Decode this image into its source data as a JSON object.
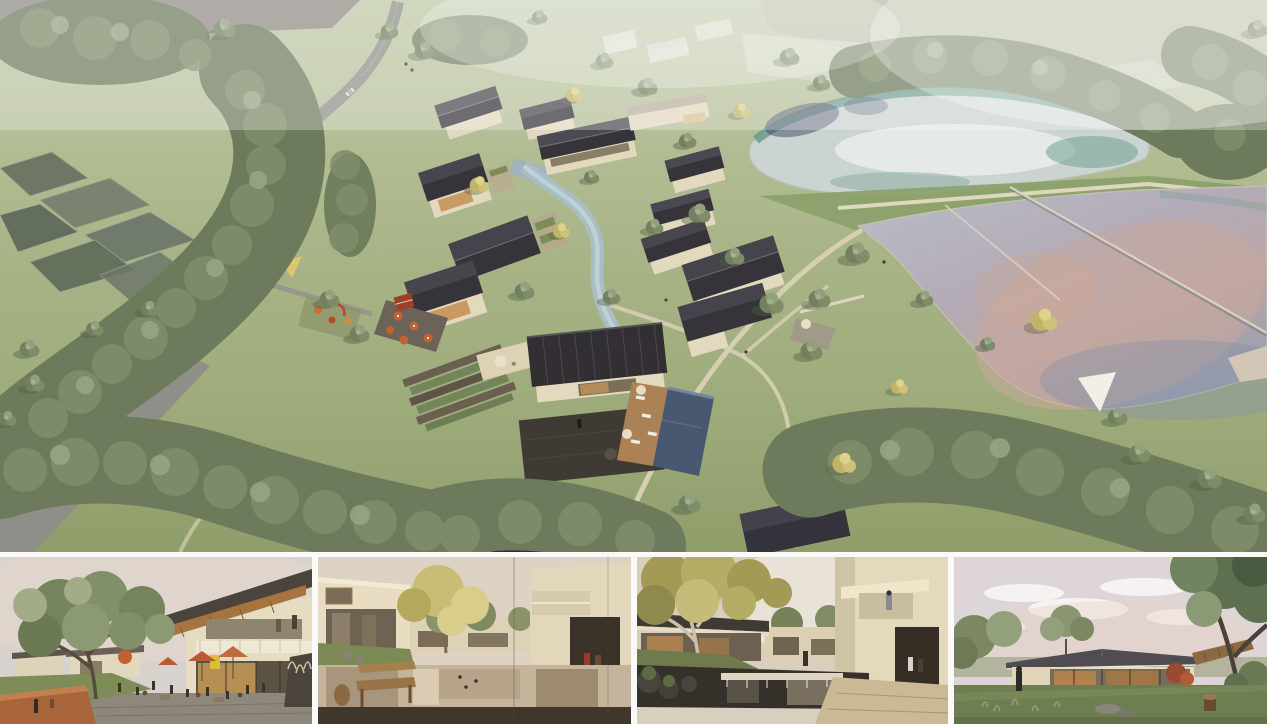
{
  "board": {
    "label": "architectural-presentation-board",
    "background": "#fbfaf8",
    "layout": {
      "main_height_px": 552,
      "gap_px": 5,
      "thumb_row_height_px": 167,
      "thumb_count": 4
    }
  },
  "colors": {
    "board": "#fbfaf8",
    "grass": "#9aa873",
    "grassLight": "#b7bc8e",
    "forest": "#6d7b5c",
    "tree": "#71805f",
    "treeYellow": "#c0b468",
    "road": "#8f8f89",
    "roof": "#36343a",
    "wall": "#e3d9bf",
    "stream": "#a9bec7",
    "lakeUpper": "#ccd4d2",
    "lakeTeal": "#5f9384",
    "lakeLower": "#b0b2bf",
    "lakePink": "#c9a89c",
    "pool": "#485870",
    "deck": "#ab8156",
    "path": "#d6cfb2",
    "umbrella": "#c2622e",
    "stone": "#6b6258",
    "haze": "#ffffff",
    "sky1": "#d8d2cf",
    "sky2": "#ddd2c4",
    "sky3": "#e9e2d6",
    "sky4": "#ded6d6"
  },
  "main_render": {
    "label": "aerial rendering of village resort with pitched-roof houses, winding stream, swimming pool, access road, farm plots and two ponds",
    "features": [
      "access-road",
      "farm-plots",
      "village-houses",
      "central-hall-courtyard",
      "swimming-pool",
      "stream",
      "upper-pond",
      "lower-pond",
      "causeway-weir",
      "forest",
      "ghost-context-buildings"
    ]
  },
  "thumbnails": [
    {
      "label": "eye-level view of plaza with cafe umbrellas, two-storey timber-roof building and large tree"
    },
    {
      "label": "eye-level view of courtyard reflecting pond with wooden bench, yellow tree and walking figures"
    },
    {
      "label": "eye-level view of pond with waterfall weir, autumn tree and cantilevered balcony building"
    },
    {
      "label": "eye-level view of single-storey glass pavilion on a lawn under pink evening sky"
    }
  ]
}
